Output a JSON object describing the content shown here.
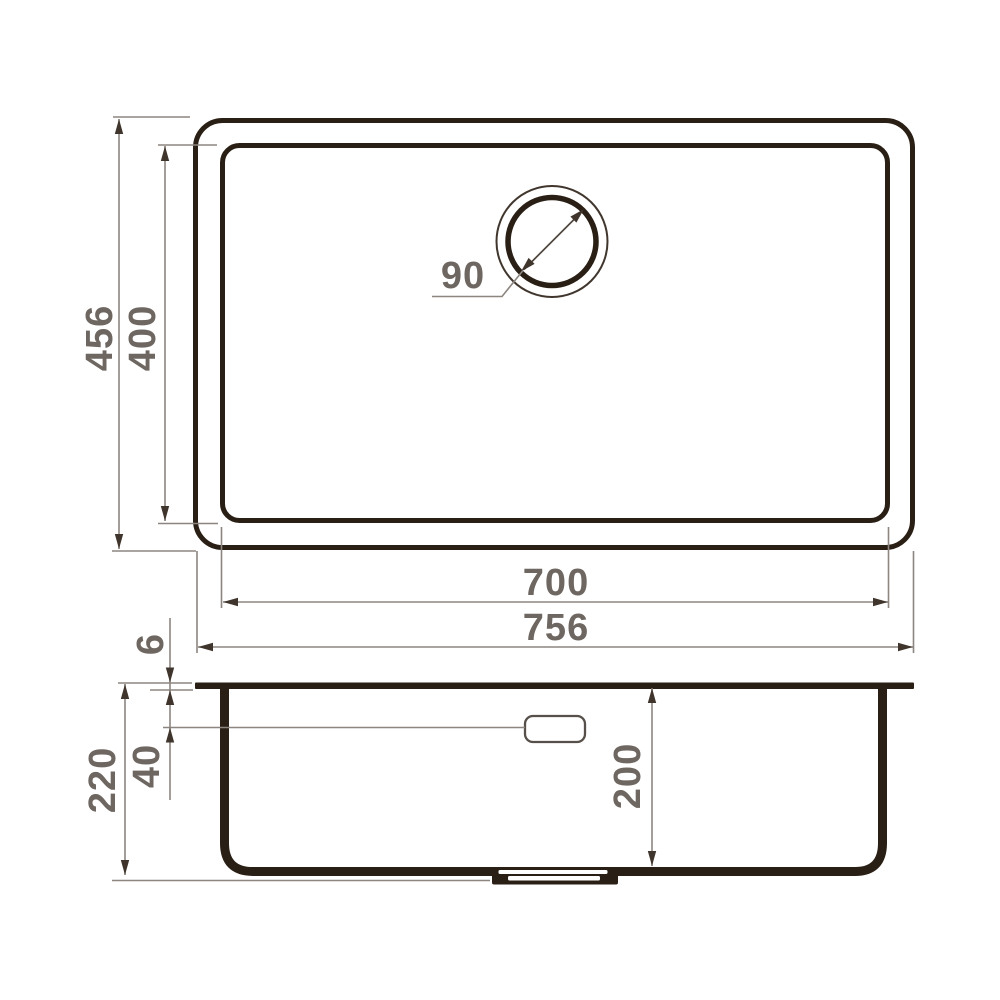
{
  "drawing": {
    "type": "sink-technical-drawing",
    "view_top": {
      "outer_width": "756",
      "inner_width": "700",
      "outer_depth": "456",
      "inner_depth": "400",
      "drain_diameter": "90"
    },
    "view_side": {
      "overall_height": "220",
      "bowl_inner_depth": "200",
      "overflow_level": "40",
      "rim_thickness": "6"
    },
    "colors": {
      "line_dark": "#2a1f15",
      "dim_line_gray": "#8d8680",
      "dim_text_gray": "#6e6761",
      "background": "#ffffff"
    }
  }
}
